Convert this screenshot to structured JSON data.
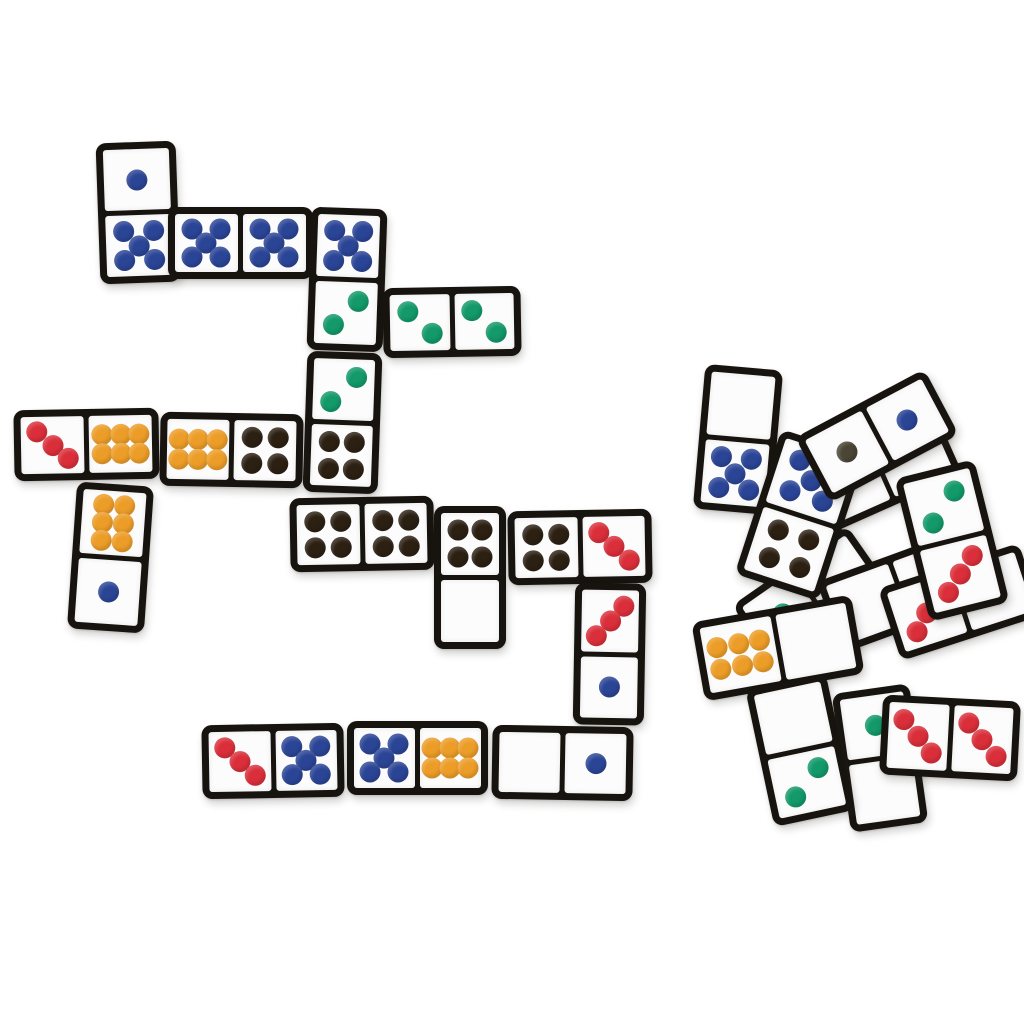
{
  "scene": {
    "description": "Photo of color-dot domino tiles on a white surface: a played chain layout on the left and a loose scattered pile on the lower right",
    "background": "#ffffff"
  },
  "colors": {
    "frame": "#17130f",
    "face": "#fcfcfc",
    "pips": {
      "blue": "#2b4596",
      "green": "#13996a",
      "red": "#da2f3a",
      "orange": "#ec9d28",
      "black": "#2c2013",
      "dark": "#4a4535"
    }
  },
  "dominoes": [
    {
      "id": "chain-1-5",
      "x": 138,
      "y": 212,
      "w": 80,
      "h": 141,
      "rot": -2,
      "o": "v",
      "halves": [
        {
          "pips": 1,
          "color": "blue"
        },
        {
          "pips": 5,
          "color": "blue"
        }
      ]
    },
    {
      "id": "chain-5-5",
      "x": 240,
      "y": 243,
      "w": 145,
      "h": 72,
      "rot": 0,
      "o": "h",
      "halves": [
        {
          "pips": 5,
          "color": "blue"
        },
        {
          "pips": 5,
          "color": "blue"
        }
      ]
    },
    {
      "id": "chain-5-2",
      "x": 347,
      "y": 279,
      "w": 76,
      "h": 143,
      "rot": 2,
      "o": "v",
      "halves": [
        {
          "pips": 5,
          "color": "blue"
        },
        {
          "pips": 2,
          "color": "green",
          "variant": "b"
        }
      ]
    },
    {
      "id": "chain-2-2",
      "x": 452,
      "y": 322,
      "w": 138,
      "h": 70,
      "rot": -1,
      "o": "h",
      "halves": [
        {
          "pips": 2,
          "color": "green",
          "variant": "a"
        },
        {
          "pips": 2,
          "color": "green",
          "variant": "a"
        }
      ]
    },
    {
      "id": "chain-2-4",
      "x": 342,
      "y": 422,
      "w": 75,
      "h": 141,
      "rot": 2,
      "o": "v",
      "halves": [
        {
          "pips": 2,
          "color": "green",
          "variant": "b"
        },
        {
          "pips": 4,
          "color": "black"
        }
      ]
    },
    {
      "id": "chain-3-6",
      "x": 86,
      "y": 444,
      "w": 145,
      "h": 71,
      "rot": -1,
      "o": "h",
      "halves": [
        {
          "pips": 3,
          "color": "red",
          "variant": "a"
        },
        {
          "pips": 6,
          "color": "orange"
        }
      ]
    },
    {
      "id": "chain-6-4",
      "x": 231,
      "y": 450,
      "w": 143,
      "h": 74,
      "rot": 1,
      "o": "h",
      "halves": [
        {
          "pips": 6,
          "color": "orange"
        },
        {
          "pips": 4,
          "color": "black"
        }
      ]
    },
    {
      "id": "chain-6-1",
      "x": 110,
      "y": 557,
      "w": 77,
      "h": 147,
      "rot": 4,
      "o": "v",
      "halves": [
        {
          "pips": 6,
          "color": "orange"
        },
        {
          "pips": 1,
          "color": "blue"
        }
      ]
    },
    {
      "id": "chain-4-4",
      "x": 362,
      "y": 534,
      "w": 144,
      "h": 74,
      "rot": -1,
      "o": "h",
      "halves": [
        {
          "pips": 4,
          "color": "black"
        },
        {
          "pips": 4,
          "color": "black"
        }
      ]
    },
    {
      "id": "chain-4-0",
      "x": 470,
      "y": 577,
      "w": 72,
      "h": 143,
      "rot": 0,
      "o": "v",
      "halves": [
        {
          "pips": 4,
          "color": "black"
        },
        {
          "pips": 0
        }
      ]
    },
    {
      "id": "chain-4-3",
      "x": 580,
      "y": 547,
      "w": 144,
      "h": 74,
      "rot": -1,
      "o": "h",
      "halves": [
        {
          "pips": 4,
          "color": "black"
        },
        {
          "pips": 3,
          "color": "red",
          "variant": "a"
        }
      ]
    },
    {
      "id": "chain-3-1",
      "x": 609,
      "y": 654,
      "w": 71,
      "h": 142,
      "rot": 1,
      "o": "v",
      "halves": [
        {
          "pips": 3,
          "color": "red",
          "variant": "b"
        },
        {
          "pips": 1,
          "color": "blue"
        }
      ]
    },
    {
      "id": "chain-3-5",
      "x": 273,
      "y": 761,
      "w": 142,
      "h": 74,
      "rot": -1,
      "o": "h",
      "halves": [
        {
          "pips": 3,
          "color": "red",
          "variant": "a"
        },
        {
          "pips": 5,
          "color": "blue"
        }
      ]
    },
    {
      "id": "chain-5-6",
      "x": 417,
      "y": 758,
      "w": 141,
      "h": 74,
      "rot": 0,
      "o": "h",
      "halves": [
        {
          "pips": 5,
          "color": "blue"
        },
        {
          "pips": 6,
          "color": "orange"
        }
      ]
    },
    {
      "id": "chain-0-1",
      "x": 562,
      "y": 763,
      "w": 141,
      "h": 74,
      "rot": 1,
      "o": "h",
      "halves": [
        {
          "pips": 0
        },
        {
          "pips": 1,
          "color": "blue"
        }
      ]
    },
    {
      "id": "pile-blank-blank-a",
      "x": 880,
      "y": 470,
      "w": 148,
      "h": 76,
      "rot": -24,
      "o": "h",
      "halves": [
        {
          "pips": 0
        },
        {
          "pips": 0
        }
      ]
    },
    {
      "id": "pile-green-hidden",
      "x": 810,
      "y": 595,
      "w": 140,
      "h": 72,
      "rot": -35,
      "o": "h",
      "halves": [
        {
          "pips": 1,
          "color": "green"
        },
        {
          "pips": 0
        }
      ]
    },
    {
      "id": "pile-blank-blank-b",
      "x": 900,
      "y": 592,
      "w": 150,
      "h": 76,
      "rot": -20,
      "o": "h",
      "halves": [
        {
          "pips": 0
        },
        {
          "pips": 0
        }
      ]
    },
    {
      "id": "pile-6-blank",
      "x": 778,
      "y": 648,
      "w": 162,
      "h": 80,
      "rot": -10,
      "o": "h",
      "halves": [
        {
          "pips": 6,
          "color": "orange"
        },
        {
          "pips": 0
        }
      ]
    },
    {
      "id": "pile-green-blank",
      "x": 880,
      "y": 758,
      "w": 78,
      "h": 140,
      "rot": -8,
      "o": "v",
      "halves": [
        {
          "pips": 1,
          "color": "green"
        },
        {
          "pips": 0
        }
      ]
    },
    {
      "id": "pile-3-hidden",
      "x": 960,
      "y": 602,
      "w": 148,
      "h": 76,
      "rot": -18,
      "o": "h",
      "halves": [
        {
          "pips": 3,
          "color": "red",
          "variant": "b"
        },
        {
          "pips": 0
        }
      ]
    },
    {
      "id": "pile-0-5",
      "x": 738,
      "y": 439,
      "w": 78,
      "h": 145,
      "rot": 5,
      "o": "v",
      "halves": [
        {
          "pips": 0
        },
        {
          "pips": 5,
          "color": "blue"
        }
      ]
    },
    {
      "id": "pile-5-4",
      "x": 800,
      "y": 515,
      "w": 88,
      "h": 152,
      "rot": 18,
      "o": "v",
      "halves": [
        {
          "pips": 5,
          "color": "blue"
        },
        {
          "pips": 4,
          "color": "black"
        }
      ]
    },
    {
      "id": "pile-1-1",
      "x": 877,
      "y": 436,
      "w": 146,
      "h": 74,
      "rot": -28,
      "o": "h",
      "halves": [
        {
          "pips": 1,
          "color": "dark"
        },
        {
          "pips": 1,
          "color": "blue"
        }
      ]
    },
    {
      "id": "pile-0-2",
      "x": 800,
      "y": 750,
      "w": 82,
      "h": 140,
      "rot": -12,
      "o": "v",
      "halves": [
        {
          "pips": 0
        },
        {
          "pips": 2,
          "color": "green",
          "variant": "b"
        }
      ]
    },
    {
      "id": "pile-2-3",
      "x": 952,
      "y": 540,
      "w": 82,
      "h": 147,
      "rot": -14,
      "o": "v",
      "halves": [
        {
          "pips": 2,
          "color": "green",
          "variant": "b"
        },
        {
          "pips": 3,
          "color": "red",
          "variant": "b"
        }
      ]
    },
    {
      "id": "pile-3-3",
      "x": 950,
      "y": 738,
      "w": 138,
      "h": 80,
      "rot": 3,
      "o": "h",
      "halves": [
        {
          "pips": 3,
          "color": "red",
          "variant": "a"
        },
        {
          "pips": 3,
          "color": "red",
          "variant": "a"
        }
      ]
    }
  ]
}
